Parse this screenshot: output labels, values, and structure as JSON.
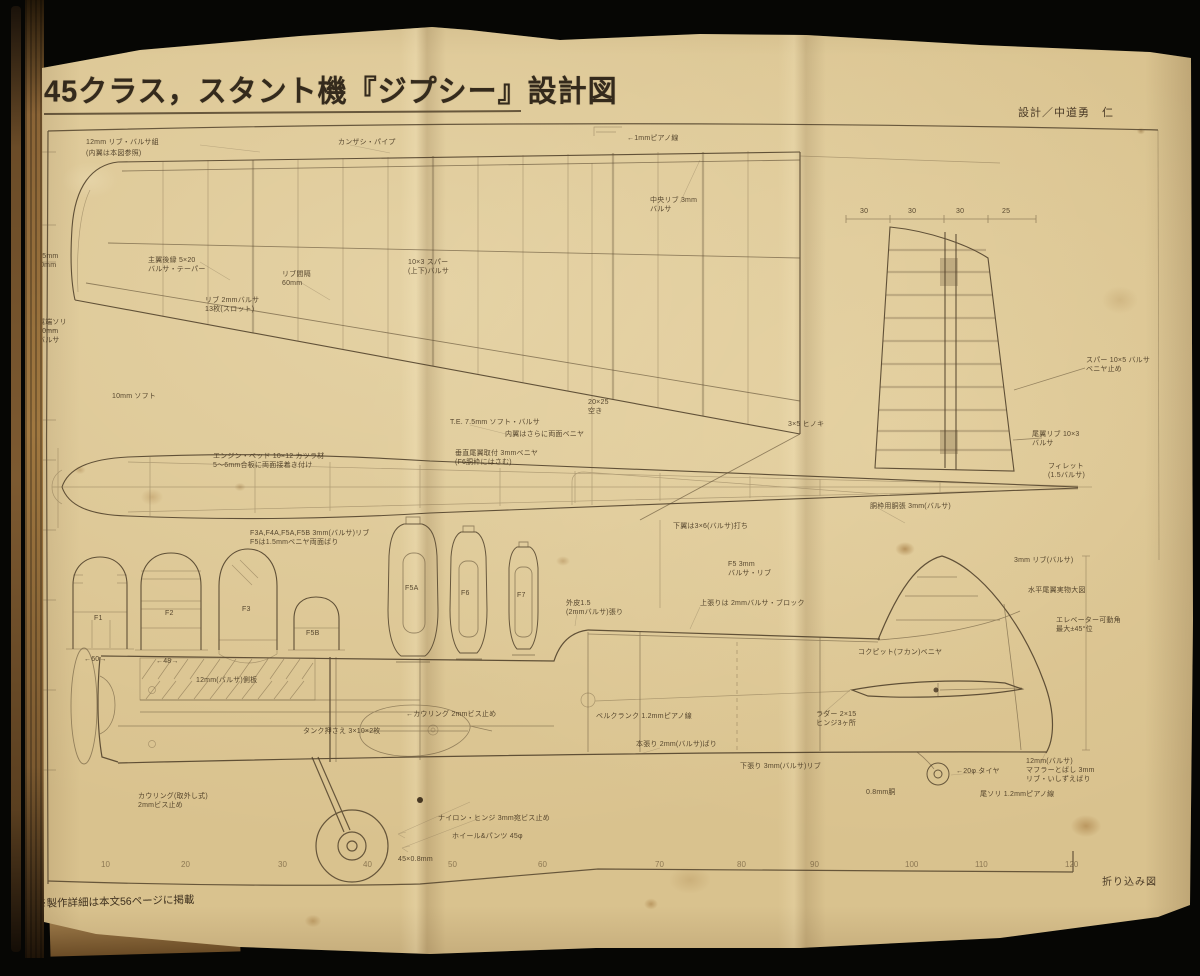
{
  "page": {
    "title": "45クラス，スタント機『ジプシー』設計図",
    "credit": "設計／中道勇　仁",
    "footer_left": "※製作詳細は本文56ページに掲載",
    "footer_right": "折り込み図"
  },
  "scale": {
    "ticks": [
      "10",
      "20",
      "30",
      "40",
      "50",
      "60",
      "70",
      "80",
      "90",
      "100",
      "110",
      "120"
    ]
  },
  "annotations": [
    "12mm リブ・バルサ組",
    "(内翼は本図参照)",
    "カンザシ・パイプ",
    "←1mmピアノ線",
    "中央リブ 3mm\nバルサ",
    "7.5mm\n10mm",
    "主翼後縁 5×20\nバルサ・テーパー",
    "リブ間隔\n60mm",
    "リブ 2mmバルサ\n13枚(スロット)",
    "10×3 スパー\n(上下)バルサ",
    "翼端ソリ\n10mm\nバルサ",
    "10mm ソフト",
    "T.E. 7.5mm ソフト・バルサ",
    "内翼はさらに両面ベニヤ",
    "20×25\n空き",
    "3×5 ヒノキ",
    "尾翼リブ 10×3\nバルサ",
    "フィレット\n(1.5バルサ)",
    "スパー 10×5 バルサ\nベニヤ止め",
    "エンジン・ベッド 10×12 カツラ材\n5〜6mm合板に両面接着き付け",
    "垂直尾翼取付 3mmベニヤ\n(F6胴枠にはさむ)",
    "下翼は3×6(バルサ)打ち",
    "F3A,F4A,F5A,F5B 3mm(バルサ)リブ\nF5は1.5mmベニヤ両面ばり",
    "F5 3mm\nバルサ・リブ",
    "3mm リブ(バルサ)",
    "水平尾翼実物大図",
    "エレベーター可動角\n最大±45°位",
    "上張りは 2mmバルサ・ブロック",
    "外皮1.5\n(2mmバルサ)張り",
    "コクピット(フカン)ベニヤ",
    "胴枠用胴張 3mm(バルサ)",
    "12mm(バルサ)側板",
    "タンク押さえ 3×10×2枚",
    "←カウリング 2mmビス止め",
    "本張り 2mm(バルサ)ばり",
    "カウリング(取外し式)\n2mmビス止め",
    "ナイロン・ヒンジ 3mm宛ビス止め",
    "ホイール&パンツ 45φ",
    "45×0.8mm",
    "ラダー 2×15\nヒンジ3ヶ所",
    "下張り 3mm(バルサ)リブ",
    "12mm(バルサ)\nマフラーとばし 3mm\nリブ・いしずえばり",
    "←20φ タイヤ",
    "0.8mm胴",
    "30",
    "30",
    "30",
    "25",
    "F1",
    "F2",
    "F3",
    "F5B",
    "F5A",
    "F6",
    "F7",
    "←60→",
    "←48→",
    "ベルクランク 1.2mmピアノ線",
    "尾ソリ 1.2mmピアノ線"
  ],
  "colors": {
    "paper": "#d9c28e",
    "ink": "#4a3b26",
    "background": "#060604"
  }
}
